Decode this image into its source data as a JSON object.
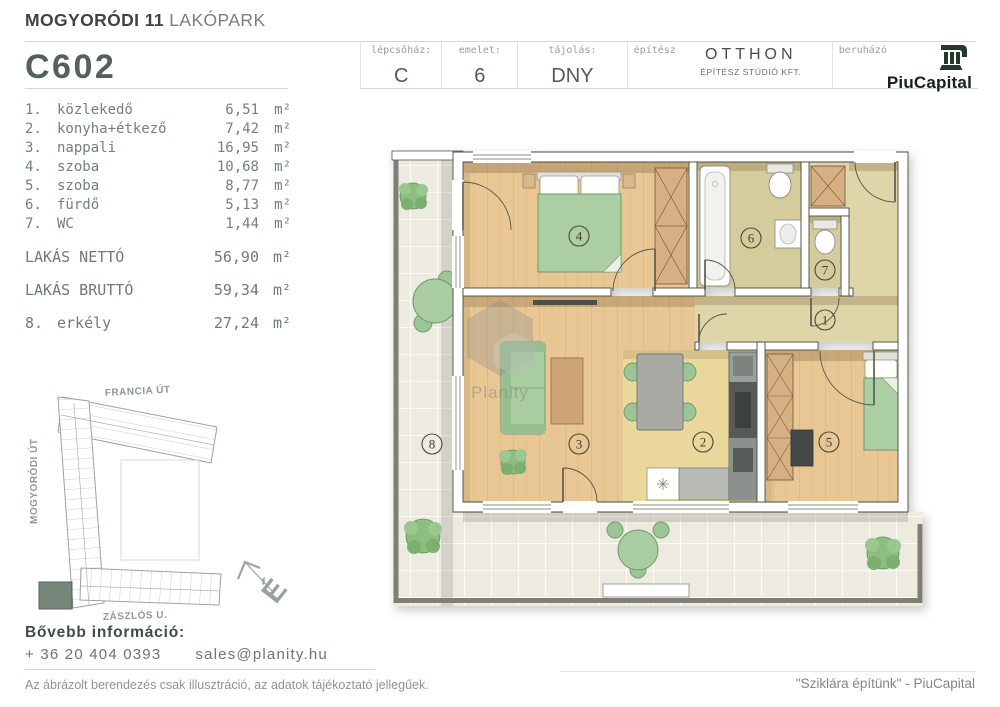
{
  "header": {
    "project": {
      "bold": "MOGYORÓDI 11",
      "light": "LAKÓPARK"
    },
    "unit_code": "C602",
    "fields": [
      {
        "label": "lépcsőház:",
        "value": "C"
      },
      {
        "label": "emelet:",
        "value": "6"
      },
      {
        "label": "tájolás:",
        "value": "DNY"
      }
    ],
    "architect": {
      "label": "építész",
      "name": "OTTHON",
      "sub": "ÉPÍTÉSZ STÚDIÓ KFT."
    },
    "developer": {
      "label": "beruházó",
      "name": "PiuCapital"
    }
  },
  "rooms": {
    "items": [
      {
        "num": "1.",
        "name": "közlekedő",
        "area": "6,51",
        "unit": "m²"
      },
      {
        "num": "2.",
        "name": "konyha+étkező",
        "area": "7,42",
        "unit": "m²"
      },
      {
        "num": "3.",
        "name": "nappali",
        "area": "16,95",
        "unit": "m²"
      },
      {
        "num": "4.",
        "name": "szoba",
        "area": "10,68",
        "unit": "m²"
      },
      {
        "num": "5.",
        "name": "szoba",
        "area": "8,77",
        "unit": "m²"
      },
      {
        "num": "6.",
        "name": "fürdő",
        "area": "5,13",
        "unit": "m²"
      },
      {
        "num": "7.",
        "name": "WC",
        "area": "1,44",
        "unit": "m²"
      }
    ],
    "net": {
      "name": "LAKÁS NETTÓ",
      "area": "56,90",
      "unit": "m²"
    },
    "gross": {
      "name": "LAKÁS BRUTTÓ",
      "area": "59,34",
      "unit": "m²"
    },
    "balcony": {
      "num": "8.",
      "name": "erkély",
      "area": "27,24",
      "unit": "m²"
    }
  },
  "plan": {
    "watermark": "Planity",
    "numbers": {
      "r1": "1",
      "r2": "2",
      "r3": "3",
      "r4": "4",
      "r5": "5",
      "r6": "6",
      "r7": "7",
      "r8": "8"
    }
  },
  "site_map": {
    "street_top": "FRANCIA ÚT",
    "street_left": "MOGYORÓDI ÚT",
    "street_bottom": "ZÁSZLÓS U.",
    "compass": "É"
  },
  "footer": {
    "info_heading": "Bővebb információ:",
    "phone": "+ 36 20 404 0393",
    "email": "sales@planity.hu",
    "disclaimer": "Az ábrázolt berendezés csak illusztráció, az adatok tájékoztató jellegűek.",
    "slogan": "\"Sziklára építünk\" - PiuCapital"
  },
  "colors": {
    "wood_floor": "#e9c795",
    "kitchen_floor": "#e9d79c",
    "hall_floor": "#d9d0a2",
    "balcony_tile": "#edeadf",
    "furniture_green": "#abcfa2",
    "wardrobe_tan": "#d6b082",
    "railing_gray": "#7f7f77",
    "brand_dark_green": "#24392a"
  }
}
